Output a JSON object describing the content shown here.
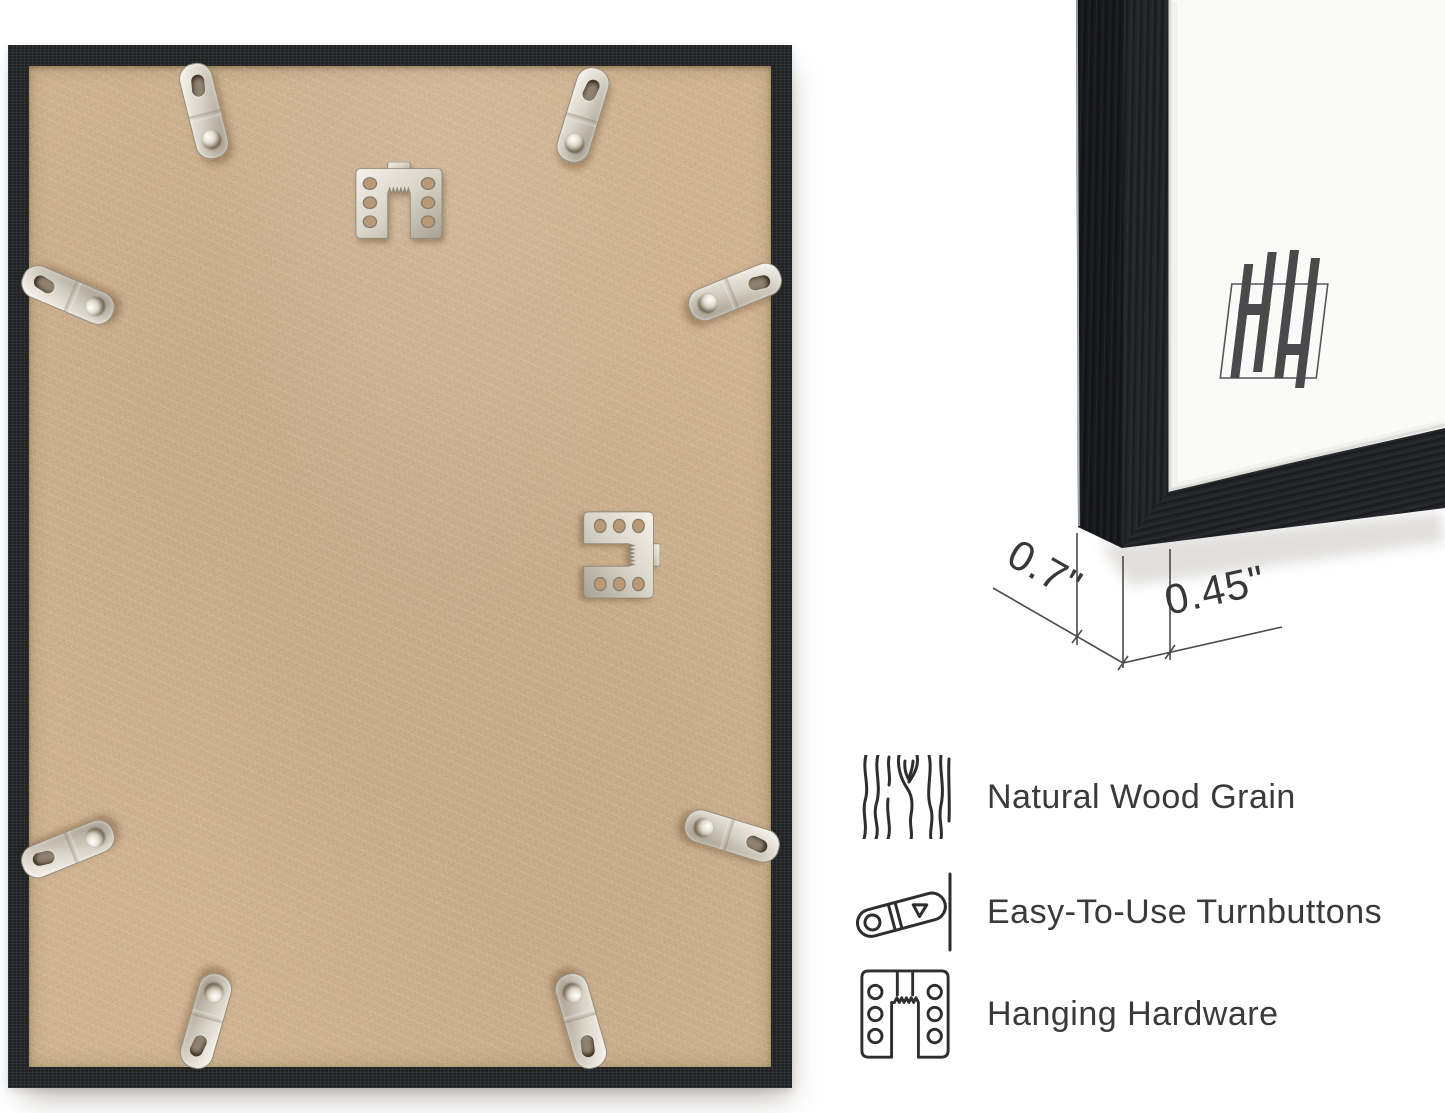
{
  "dimensions": {
    "depth": "0.7\"",
    "width": "0.45\""
  },
  "features": [
    {
      "icon": "wood-grain-icon",
      "label": "Natural Wood Grain"
    },
    {
      "icon": "turnbutton-icon",
      "label": "Easy-To-Use Turnbuttons"
    },
    {
      "icon": "hanging-hardware-icon",
      "label": "Hanging Hardware"
    }
  ],
  "brand": {
    "monogram": "HH"
  },
  "hardware": {
    "turnbutton_count": 8,
    "sawtooth_hanger_count": 2
  },
  "colors": {
    "frame_black": "#202224",
    "mdf_tan": "#c8a67f",
    "metal_silver": "#d8d3c7",
    "ink": "#383838",
    "dimension_line": "#4b4b4b",
    "background": "#ffffff"
  }
}
